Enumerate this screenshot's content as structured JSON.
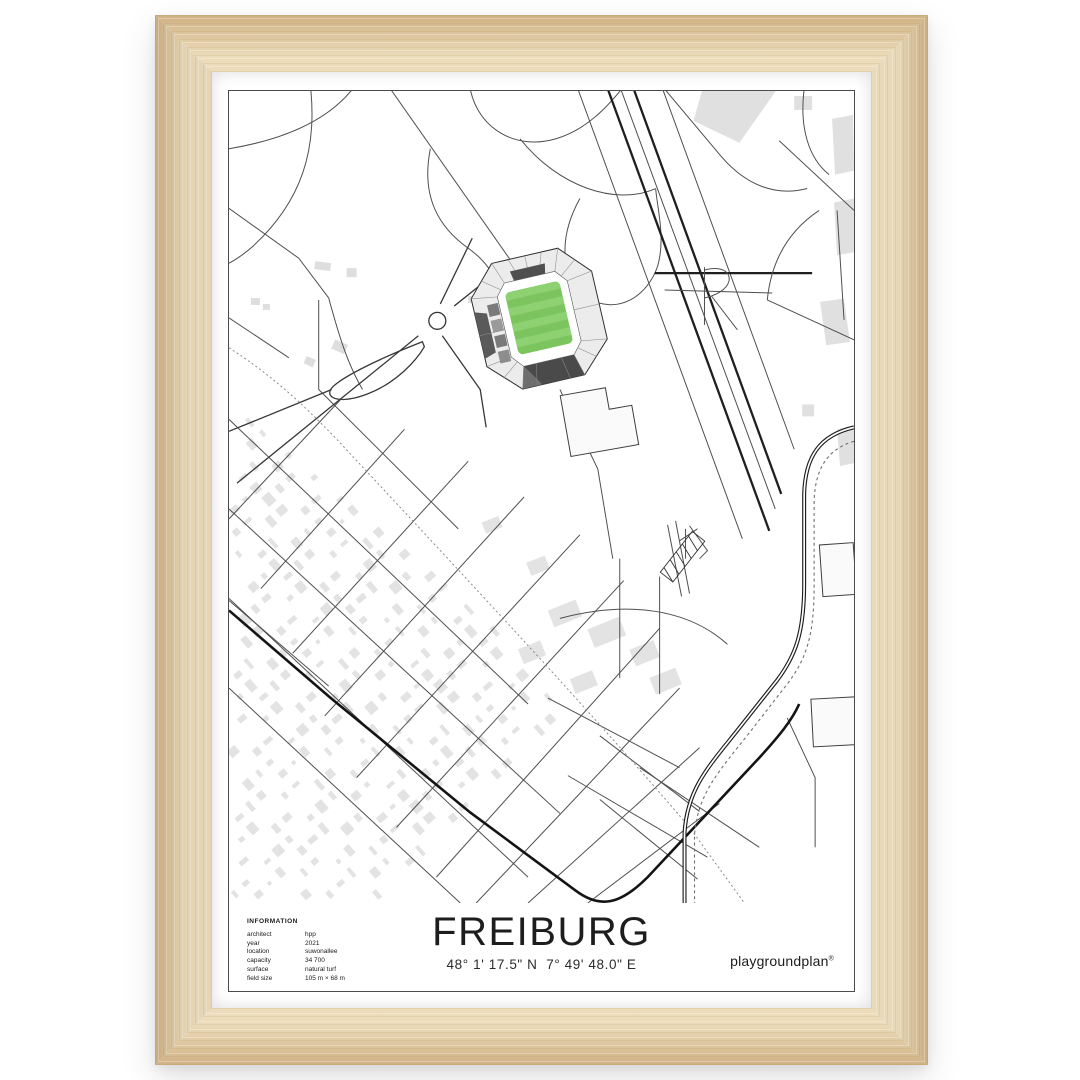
{
  "poster": {
    "title": "FREIBURG",
    "coordinates": "48° 1' 17.5\" N  7° 49' 48.0\" E",
    "brand": "playgroundplan",
    "brand_mark": "®",
    "info": {
      "heading": "INFORMATION",
      "rows": [
        {
          "label": "architect",
          "value": "hpp"
        },
        {
          "label": "year",
          "value": "2021"
        },
        {
          "label": "location",
          "value": "suwonallee"
        },
        {
          "label": "capacity",
          "value": "34 700"
        },
        {
          "label": "surface",
          "value": "natural turf"
        },
        {
          "label": "field size",
          "value": "105 m × 68 m"
        }
      ]
    },
    "colors": {
      "pitch_green": "#7cc45e",
      "pitch_stripe": "#8ed173",
      "road_dark": "#141414",
      "building_gray": "#e3e3e3",
      "frame_wood": "#ecdcba"
    }
  }
}
